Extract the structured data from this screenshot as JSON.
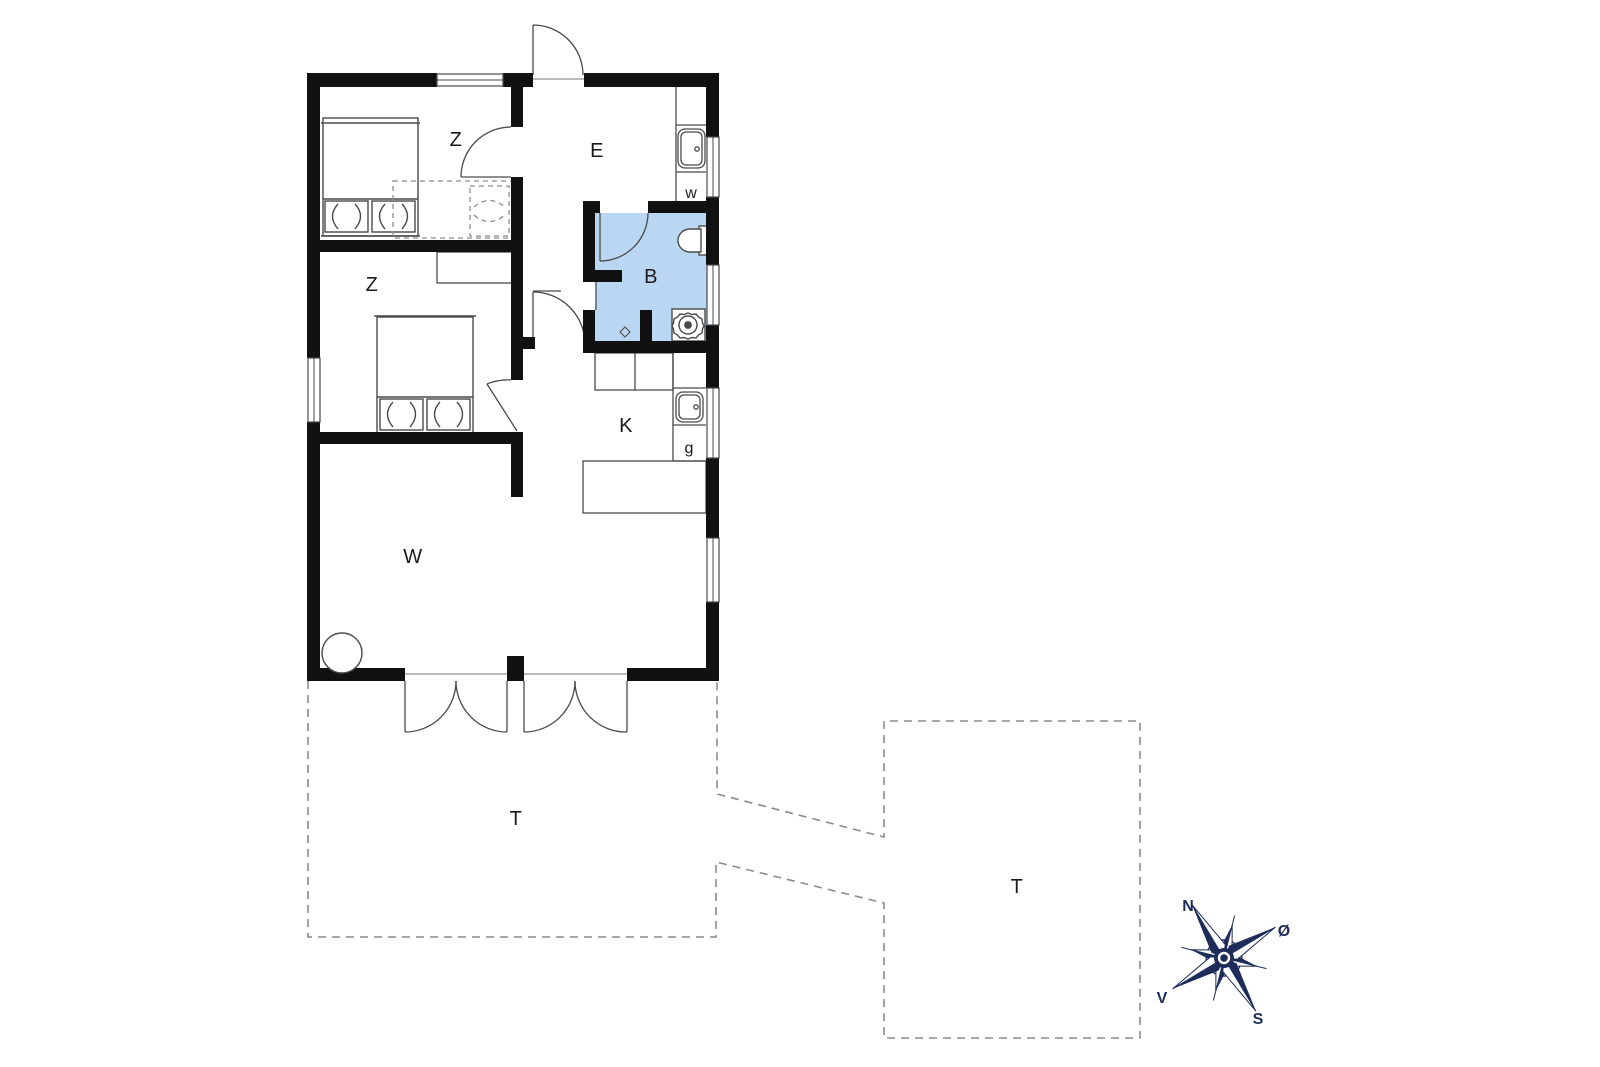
{
  "plan": {
    "type": "floor-plan",
    "rooms": [
      {
        "id": "bedroom-1",
        "label": "Z"
      },
      {
        "id": "bedroom-2",
        "label": "Z"
      },
      {
        "id": "entry",
        "label": "E"
      },
      {
        "id": "bathroom",
        "label": "B"
      },
      {
        "id": "kitchen",
        "label": "K"
      },
      {
        "id": "living-room",
        "label": "W"
      },
      {
        "id": "terrace-main",
        "label": "T"
      },
      {
        "id": "terrace-secondary",
        "label": "T"
      }
    ],
    "appliances": [
      {
        "id": "washing-machine",
        "label": "w"
      },
      {
        "id": "stove-appliance",
        "label": "g"
      }
    ],
    "compass": {
      "north": "N",
      "east": "Ø",
      "south": "S",
      "west": "V",
      "rotation_deg": -31
    },
    "colors": {
      "wall": "#111111",
      "bathroom_fill": "#b9d6f2",
      "fixture_line": "#4a4a4a",
      "dashed_line": "#8c8c8c",
      "compass_navy": "#1e2c5a"
    }
  }
}
